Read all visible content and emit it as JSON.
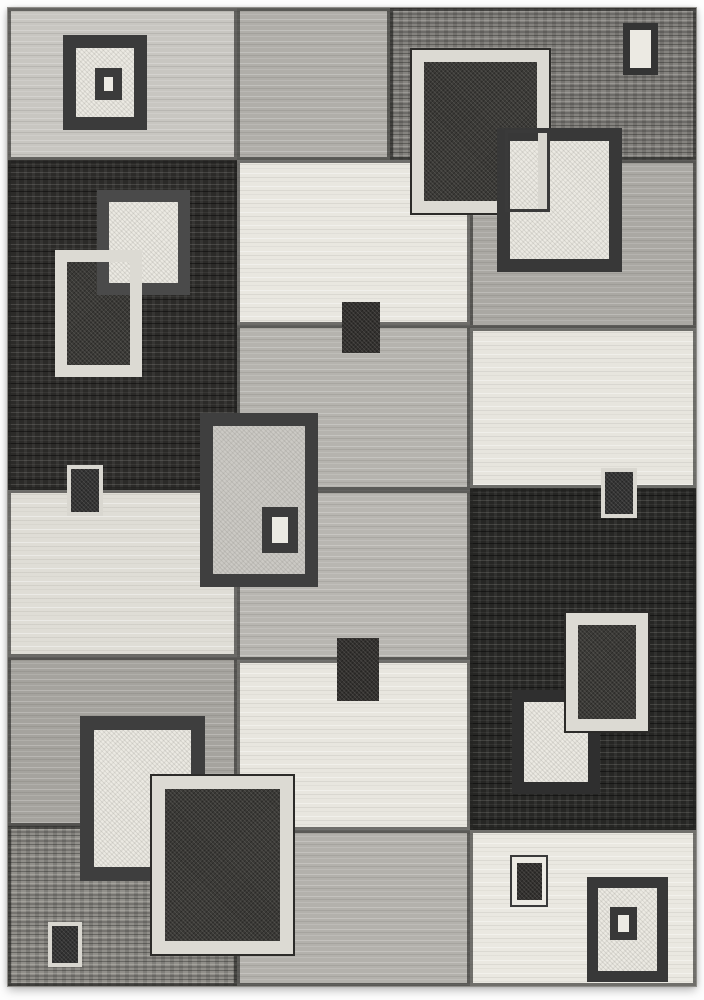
{
  "meta": {
    "content_type": "product-photo",
    "subject": "Modern geometric patchwork area rug with overlapping retro squares",
    "color_scheme": "black, charcoal, grey, ivory",
    "page_background": "#fdfdfd"
  },
  "palette": {
    "black_block": "#2b2a28",
    "charcoal_fill": "#3b3a37",
    "dark_frame": "#3b3b3b",
    "grey_dark": "#85837f",
    "grey_mid": "#b0aea9",
    "grey_light": "#c8c6c1",
    "ivory": "#e9e7e0",
    "light_frame": "#dcdad3",
    "boundary_line": "rgba(30,30,28,0.60)",
    "thin_outline": "#2c2b29"
  },
  "rug": {
    "x": 8,
    "y": 8,
    "w": 688,
    "h": 978,
    "blocks": [
      {
        "name": "top-left-light-grey",
        "x": 0,
        "y": 0,
        "w": 229,
        "h": 152,
        "fill": "#c8c6c1",
        "tex": "stripe"
      },
      {
        "name": "top-mid-grey",
        "x": 229,
        "y": 0,
        "w": 153,
        "h": 152,
        "fill": "#b0aea9",
        "tex": "stripe"
      },
      {
        "name": "top-right-dark-grey",
        "x": 382,
        "y": 0,
        "w": 306,
        "h": 152,
        "fill": "#85837f",
        "tex": "streak"
      },
      {
        "name": "left-black",
        "x": 0,
        "y": 152,
        "w": 229,
        "h": 330,
        "fill": "#2b2a28",
        "tex": "black"
      },
      {
        "name": "mid-ivory",
        "x": 229,
        "y": 152,
        "w": 233,
        "h": 165,
        "fill": "#e9e7e0",
        "tex": "cream"
      },
      {
        "name": "right-grey",
        "x": 462,
        "y": 152,
        "w": 226,
        "h": 168,
        "fill": "#aaa8a3",
        "tex": "stripe"
      },
      {
        "name": "mid-grey",
        "x": 229,
        "y": 317,
        "w": 233,
        "h": 165,
        "fill": "#b5b3ae",
        "tex": "stripe"
      },
      {
        "name": "right-ivory",
        "x": 462,
        "y": 320,
        "w": 226,
        "h": 160,
        "fill": "#e7e5de",
        "tex": "cream"
      },
      {
        "name": "left-ivory",
        "x": 0,
        "y": 482,
        "w": 229,
        "h": 167,
        "fill": "#dfddd6",
        "tex": "cream"
      },
      {
        "name": "mid-grey-2",
        "x": 229,
        "y": 482,
        "w": 233,
        "h": 170,
        "fill": "#b8b6b1",
        "tex": "stripe"
      },
      {
        "name": "right-black",
        "x": 462,
        "y": 480,
        "w": 226,
        "h": 342,
        "fill": "#262624",
        "tex": "black"
      },
      {
        "name": "left-grey",
        "x": 0,
        "y": 649,
        "w": 229,
        "h": 169,
        "fill": "#a5a39e",
        "tex": "stripe"
      },
      {
        "name": "mid-ivory-2",
        "x": 229,
        "y": 652,
        "w": 233,
        "h": 170,
        "fill": "#e8e6df",
        "tex": "cream"
      },
      {
        "name": "bottom-left-grey",
        "x": 0,
        "y": 818,
        "w": 229,
        "h": 160,
        "fill": "#918f8a",
        "tex": "streak"
      },
      {
        "name": "bottom-mid-grey",
        "x": 229,
        "y": 822,
        "w": 233,
        "h": 156,
        "fill": "#b3b1ac",
        "tex": "stripe"
      },
      {
        "name": "bottom-right-ivory",
        "x": 462,
        "y": 822,
        "w": 226,
        "h": 156,
        "fill": "#eae8e1",
        "tex": "cream"
      }
    ],
    "motifs": [
      {
        "name": "tl-ivory-square",
        "x": 55,
        "y": 27,
        "w": 84,
        "h": 95,
        "frame": "#3b3b3b",
        "fw": 13,
        "fill": "#eceae3",
        "tex": "speck"
      },
      {
        "name": "tl-ivory-square-inner",
        "x": 87,
        "y": 60,
        "w": 27,
        "h": 32,
        "frame": "#3b3b3b",
        "fw": 9,
        "fill": "#eceae3"
      },
      {
        "name": "tr-framed-charcoal",
        "x": 404,
        "y": 42,
        "w": 137,
        "h": 163,
        "frame": "#dcdad3",
        "fw": 12,
        "fill": "#3b3a37",
        "tex": "grain",
        "outline": true
      },
      {
        "name": "tr-ivory-square",
        "x": 489,
        "y": 120,
        "w": 125,
        "h": 144,
        "frame": "#383838",
        "fw": 13,
        "fill": "#eceae3",
        "tex": "speck"
      },
      {
        "name": "tr-frame-overlap-bar",
        "x": 530,
        "y": 122,
        "w": 12,
        "h": 80,
        "fill": "#d8d6cf"
      },
      {
        "name": "tr-thin-outline",
        "x": 497,
        "y": 122,
        "w": 45,
        "h": 82,
        "frame": "#3a3a3a",
        "fw": 3,
        "fill": "transparent"
      },
      {
        "name": "tr-small-ivory",
        "x": 615,
        "y": 15,
        "w": 35,
        "h": 52,
        "frame": "#343434",
        "fw": 7,
        "fill": "#eceae3"
      },
      {
        "name": "left-charcoal-fill",
        "x": 59,
        "y": 254,
        "w": 63,
        "h": 103,
        "fill": "#3b3a37",
        "tex": "grain"
      },
      {
        "name": "left-ivory-square",
        "x": 89,
        "y": 182,
        "w": 93,
        "h": 105,
        "frame": "#4a4a4a",
        "fw": 12,
        "fill": "#eceae3",
        "tex": "speck"
      },
      {
        "name": "left-light-frame",
        "x": 47,
        "y": 242,
        "w": 87,
        "h": 127,
        "frame": "#dcdad3",
        "fw": 12,
        "fill": "transparent"
      },
      {
        "name": "center-small-charcoal",
        "x": 334,
        "y": 294,
        "w": 38,
        "h": 51,
        "fill": "#33312f",
        "tex": "grain"
      },
      {
        "name": "center-grey-square",
        "x": 192,
        "y": 405,
        "w": 118,
        "h": 174,
        "frame": "#3f3f3f",
        "fw": 13,
        "fill": "#cccac5",
        "tex": "speck"
      },
      {
        "name": "center-grey-square-inner",
        "x": 254,
        "y": 499,
        "w": 36,
        "h": 46,
        "frame": "#3c3c3c",
        "fw": 10,
        "fill": "#eceae3"
      },
      {
        "name": "left-small-framed",
        "x": 59,
        "y": 457,
        "w": 36,
        "h": 51,
        "frame": "#d9d7d0",
        "fw": 4,
        "fill": "#343434",
        "tex": "grain"
      },
      {
        "name": "right-small-framed",
        "x": 593,
        "y": 460,
        "w": 36,
        "h": 50,
        "frame": "#d9d7d0",
        "fw": 4,
        "fill": "#343434",
        "tex": "grain"
      },
      {
        "name": "center-small-charcoal-2",
        "x": 329,
        "y": 630,
        "w": 42,
        "h": 63,
        "fill": "#33312f",
        "tex": "grain"
      },
      {
        "name": "br-ivory-square",
        "x": 504,
        "y": 682,
        "w": 88,
        "h": 104,
        "frame": "#2f2f2f",
        "fw": 12,
        "fill": "#eceae3",
        "tex": "speck"
      },
      {
        "name": "br-framed-charcoal",
        "x": 558,
        "y": 605,
        "w": 82,
        "h": 118,
        "frame": "#dcdad3",
        "fw": 12,
        "fill": "#3b3a37",
        "tex": "grain",
        "outline": true
      },
      {
        "name": "bl-ivory-square",
        "x": 72,
        "y": 708,
        "w": 125,
        "h": 165,
        "frame": "#3e3e3e",
        "fw": 14,
        "fill": "#eceae3",
        "tex": "speck"
      },
      {
        "name": "bl-framed-charcoal",
        "x": 144,
        "y": 768,
        "w": 141,
        "h": 178,
        "frame": "#dcdad3",
        "fw": 13,
        "fill": "#3b3a37",
        "tex": "grain",
        "outline": true
      },
      {
        "name": "bl-small-framed",
        "x": 40,
        "y": 914,
        "w": 34,
        "h": 45,
        "frame": "#d9d7d0",
        "fw": 4,
        "fill": "#343434",
        "tex": "grain"
      },
      {
        "name": "br-small-double",
        "x": 502,
        "y": 847,
        "w": 38,
        "h": 52,
        "frame": "#3a3a3a",
        "fw": 2,
        "fill": "#eceae3"
      },
      {
        "name": "br-small-double-core",
        "x": 509,
        "y": 855,
        "w": 25,
        "h": 37,
        "fill": "#33312f",
        "tex": "grain"
      },
      {
        "name": "br-square",
        "x": 579,
        "y": 869,
        "w": 81,
        "h": 105,
        "frame": "#383838",
        "fw": 11,
        "fill": "#eceae3",
        "tex": "speck"
      },
      {
        "name": "br-square-inner",
        "x": 602,
        "y": 899,
        "w": 27,
        "h": 33,
        "frame": "#383838",
        "fw": 8,
        "fill": "#eceae3"
      }
    ]
  }
}
